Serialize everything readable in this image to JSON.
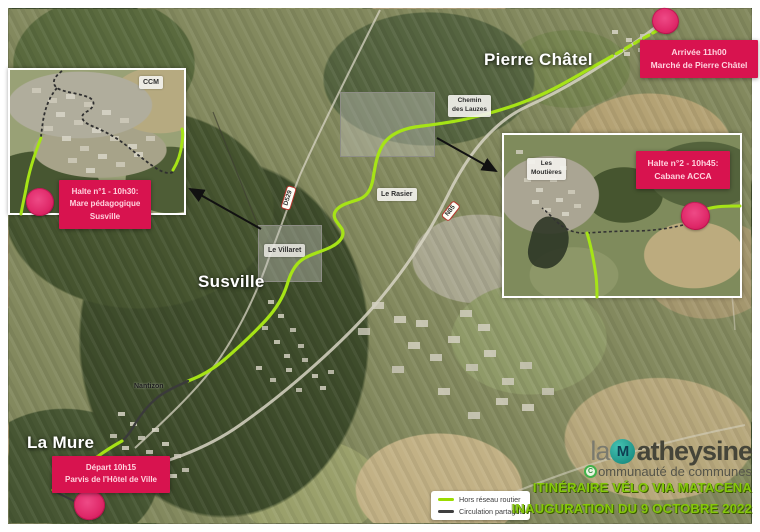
{
  "towns": {
    "pierre_chatel": "Pierre Châtel",
    "susville": "Susville",
    "la_mure": "La Mure",
    "nantizon": "Nantizon"
  },
  "hamlets": {
    "ccm": "CCM",
    "chemin_des_lauzes_1": "Chemin",
    "chemin_des_lauzes_2": "des Lauzes",
    "le_rasier": "Le Rasier",
    "le_villaret": "Le Villaret",
    "les_moutieres_1": "Les",
    "les_moutieres_2": "Moutières"
  },
  "road_signs": {
    "d529": "D529",
    "n85": "N85"
  },
  "stops": {
    "depart": {
      "line1": "Départ 10h15",
      "line2": "Parvis de l'Hôtel de Ville"
    },
    "halte1": {
      "line1": "Halte n°1 - 10h30:",
      "line2": "Mare pédagogique",
      "line3": "Susville"
    },
    "halte2": {
      "line1": "Halte n°2 - 10h45:",
      "line2": "Cabane ACCA"
    },
    "arrivee": {
      "line1": "Arrivée 11h00",
      "line2": "Marché de Pierre Châtel"
    }
  },
  "legend": {
    "off_road": "Hors réseau routier",
    "shared": "Circulation partagée"
  },
  "logo": {
    "prefix": "la",
    "monogram": "M",
    "name_rest": "atheysine",
    "tagline_initial": "C",
    "tagline_rest": "ommunauté de communes"
  },
  "title": {
    "line1": "ITINÉRAIRE VÉLO VIA MATACENA",
    "line2": "INAUGURATION DU 9 OCTOBRE 2022"
  },
  "colors": {
    "route_off_road": "#a6e416",
    "route_shared": "#3a3a3a",
    "route_orange": "#e8821e",
    "stop_badge_red": "#d8134f",
    "marker_pink": "#e02a6a",
    "title_green": "#85c80a",
    "logo_teal": "#1f9488"
  }
}
